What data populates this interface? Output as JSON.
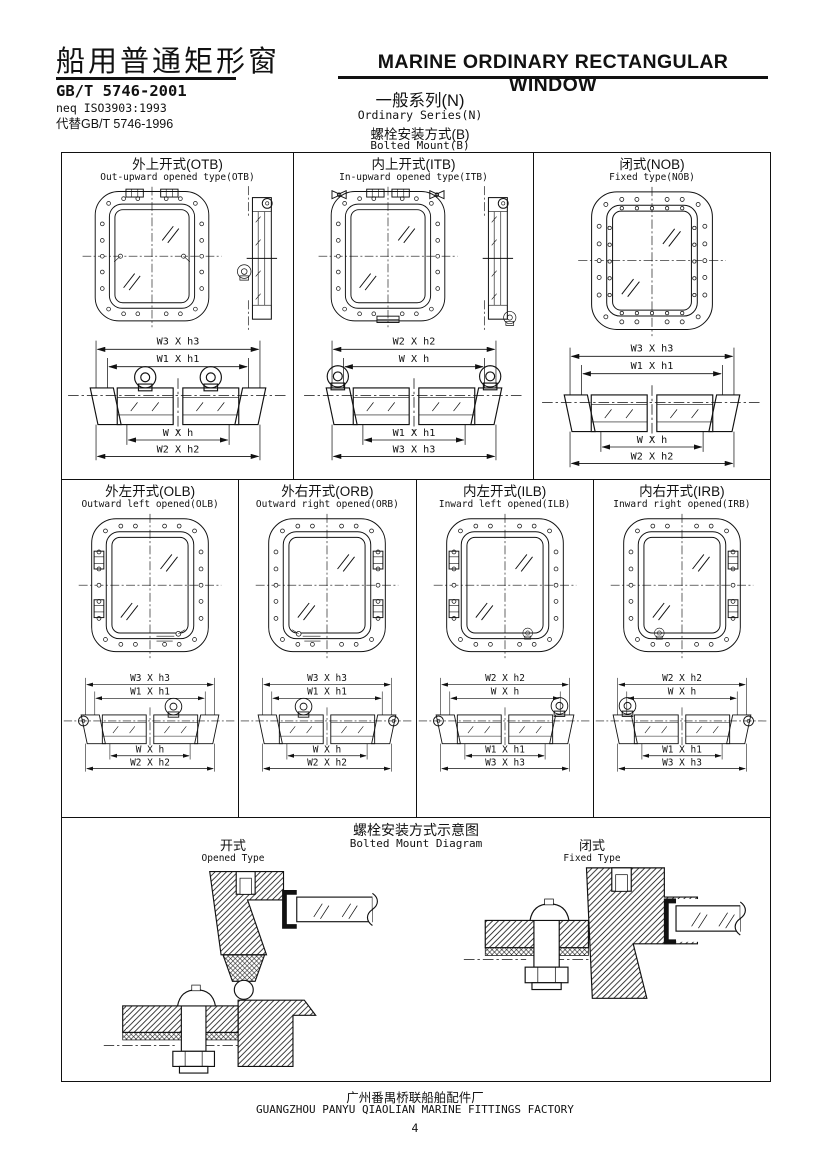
{
  "colors": {
    "ink": "#111111",
    "paper": "#ffffff"
  },
  "header": {
    "title_cn": "船用普通矩形窗",
    "title_en": "MARINE ORDINARY RECTANGULAR WINDOW",
    "standard_no": "GB/T 5746-2001",
    "equivalence": "neq ISO3903:1993",
    "replaces": "代替GB/T 5746-1996",
    "series_cn": "一般系列(N)",
    "series_en": "Ordinary Series(N)",
    "mount_cn": "螺栓安装方式(B)",
    "mount_en": "Bolted Mount(B)"
  },
  "type_cells": [
    {
      "title_cn": "外上开式(OTB)",
      "title_en": "Out-upward opened type(OTB)",
      "dims": [
        "W3 X h3",
        "W1 X h1",
        "W X h",
        "W2 X h2"
      ]
    },
    {
      "title_cn": "内上开式(ITB)",
      "title_en": "In-upward opened type(ITB)",
      "dims": [
        "W2 X h2",
        "W X h",
        "W1 X h1",
        "W3 X h3"
      ]
    },
    {
      "title_cn": "闭式(NOB)",
      "title_en": "Fixed type(NOB)",
      "dims": [
        "W3 X h3",
        "W1 X h1",
        "W X h",
        "W2 X h2"
      ]
    },
    {
      "title_cn": "外左开式(OLB)",
      "title_en": "Outward left opened(OLB)",
      "dims": [
        "W3 X h3",
        "W1 X h1",
        "W X h",
        "W2 X h2"
      ]
    },
    {
      "title_cn": "外右开式(ORB)",
      "title_en": "Outward right opened(ORB)",
      "dims": [
        "W3 X h3",
        "W1 X h1",
        "W X h",
        "W2 X h2"
      ]
    },
    {
      "title_cn": "内左开式(ILB)",
      "title_en": "Inward left opened(ILB)",
      "dims": [
        "W2 X h2",
        "W X h",
        "W1 X h1",
        "W3 X h3"
      ]
    },
    {
      "title_cn": "内右开式(IRB)",
      "title_en": "Inward right opened(IRB)",
      "dims": [
        "W2 X h2",
        "W X h",
        "W1 X h1",
        "W3 X h3"
      ]
    }
  ],
  "diagram": {
    "title_cn": "螺栓安装方式示意图",
    "title_en": "Bolted Mount Diagram",
    "opened_cn": "开式",
    "opened_en": "Opened Type",
    "fixed_cn": "闭式",
    "fixed_en": "Fixed Type"
  },
  "footer": {
    "factory_cn": "广州番禺桥联船舶配件厂",
    "factory_en": "GUANGZHOU PANYU QIAOLIAN MARINE FITTINGS FACTORY",
    "page": "4"
  }
}
